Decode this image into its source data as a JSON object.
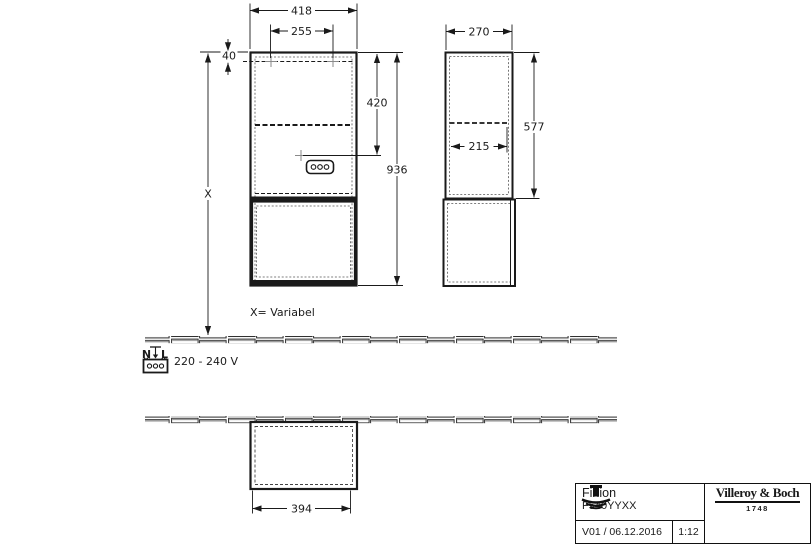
{
  "dimensions": {
    "front": {
      "total_width": "418",
      "inner_width": "255",
      "top_offset": "40",
      "upper_height": "420",
      "total_height": "936",
      "variable_height": "X"
    },
    "side": {
      "depth": "270",
      "upper_height": "577",
      "inner_depth": "215"
    },
    "bottom": {
      "opening_width": "394"
    }
  },
  "annotations": {
    "variable_note": "X= Variabel",
    "voltage": "220 - 240 V",
    "wire_n": "N",
    "wire_l": "L"
  },
  "title_block": {
    "series": "Finion",
    "article": "F540YYXX",
    "version_date": "V01 / 06.12.2016",
    "scale": "1:12",
    "brand": "Villeroy & Boch",
    "brand_year": "1748"
  }
}
